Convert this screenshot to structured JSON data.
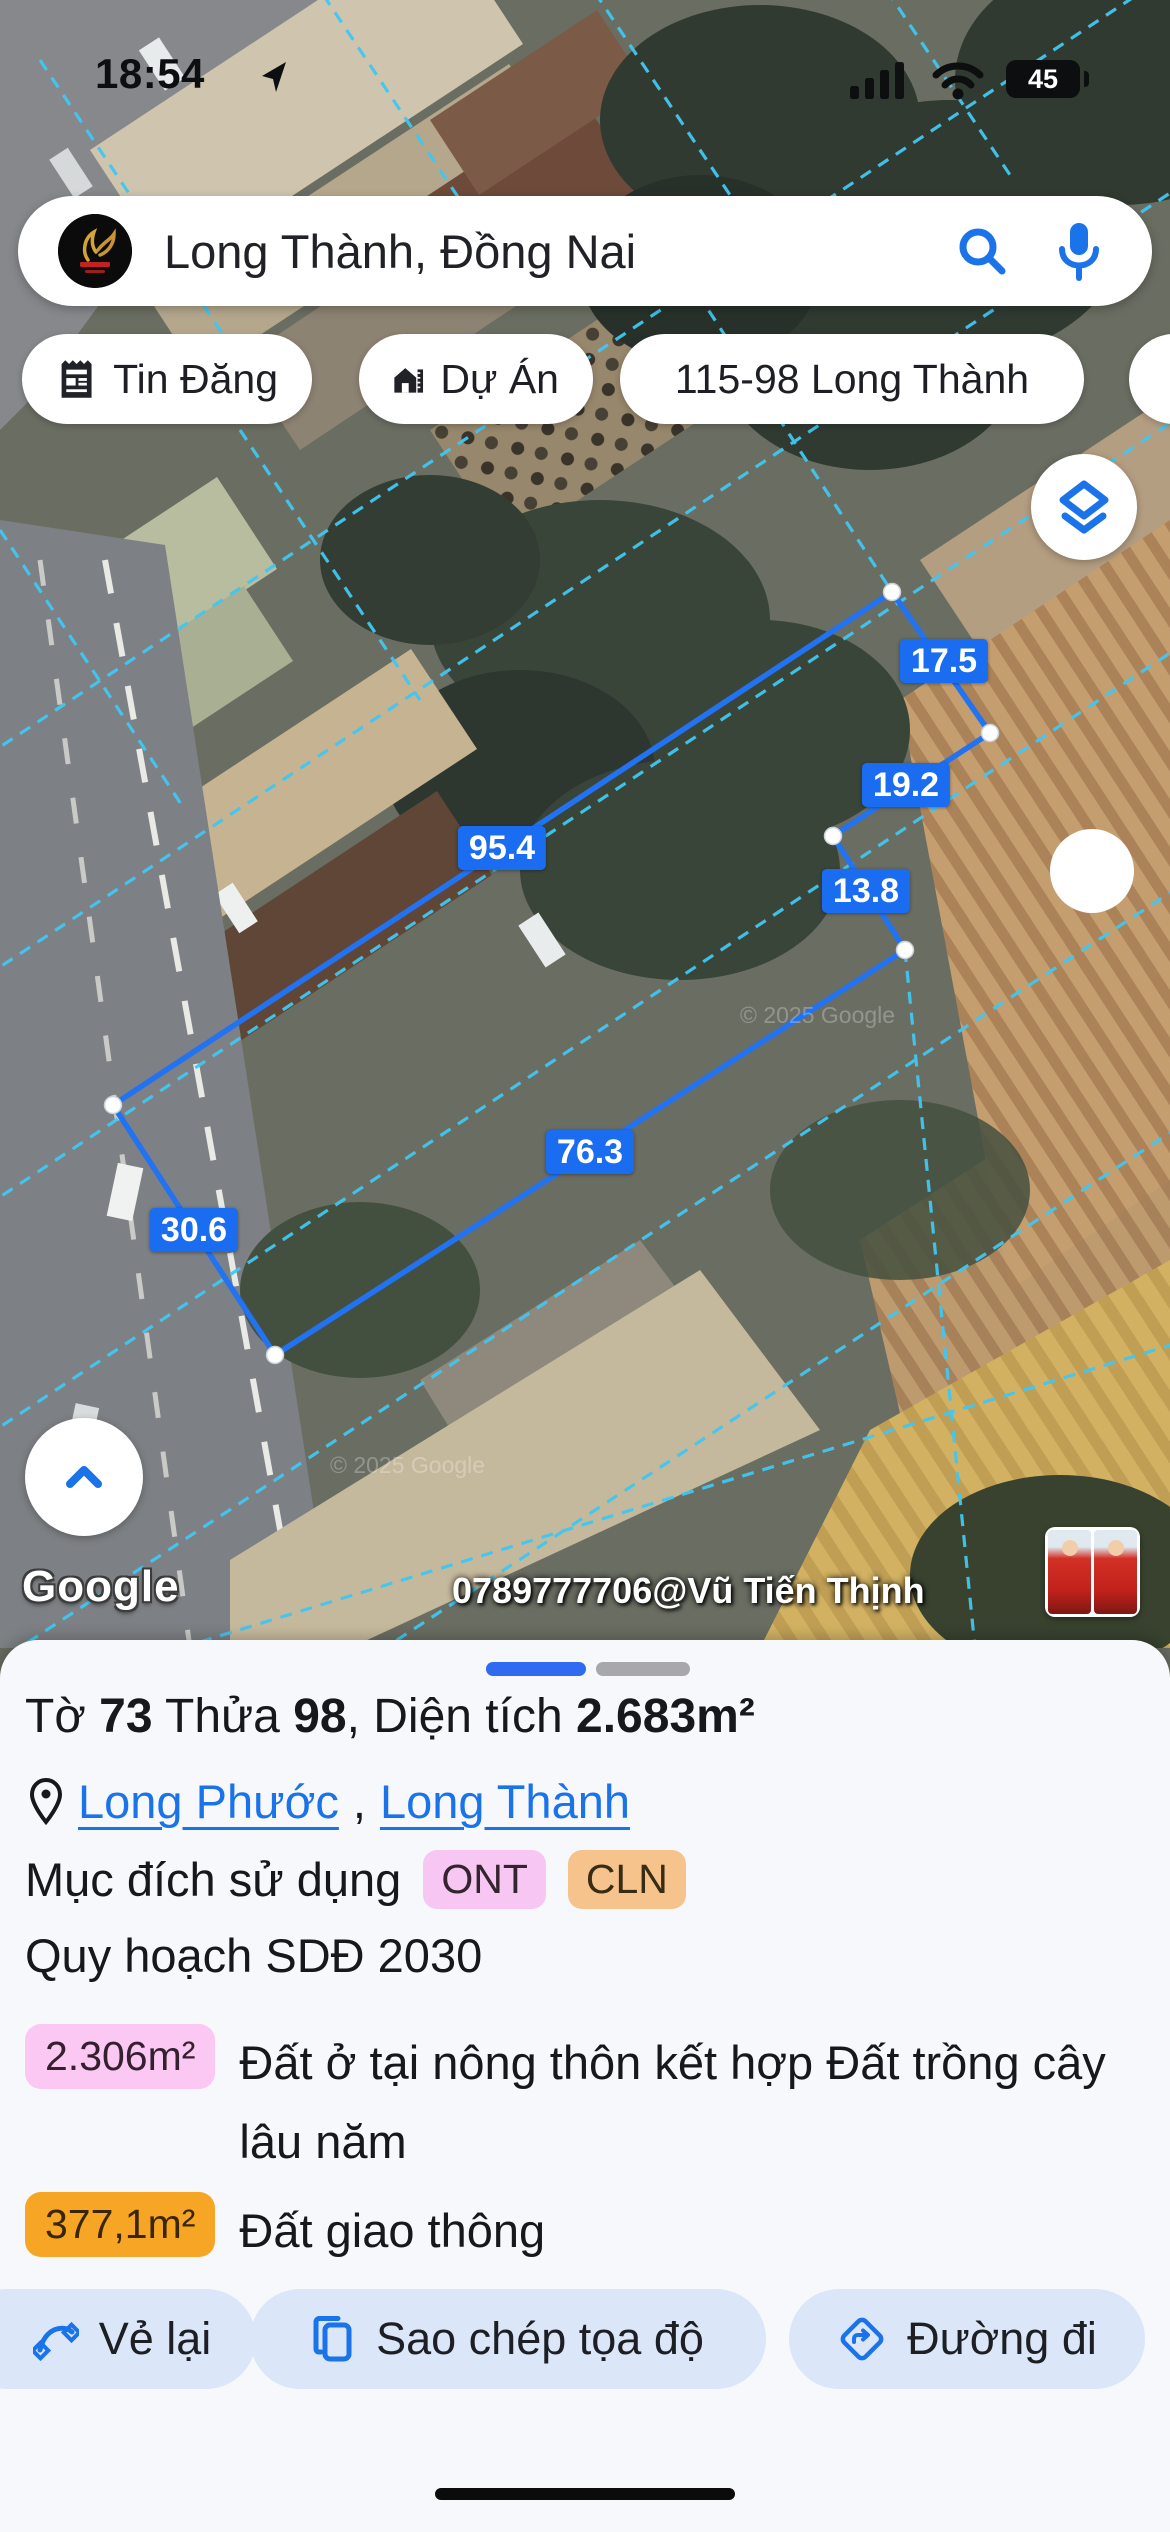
{
  "status_bar": {
    "time": "18:54",
    "battery": "45"
  },
  "search": {
    "query": "Long Thành, Đồng Nai"
  },
  "chips": [
    {
      "label": "Tin Đăng"
    },
    {
      "label": "Dự Án"
    },
    {
      "label": "115-98 Long Thành"
    },
    {
      "label": "3"
    }
  ],
  "map": {
    "measurements": [
      {
        "value": "17.5"
      },
      {
        "value": "19.2"
      },
      {
        "value": "13.8"
      },
      {
        "value": "95.4"
      },
      {
        "value": "76.3"
      },
      {
        "value": "30.6"
      }
    ],
    "google_logo": "Google",
    "watermark": "0789777706@Vũ Tiến Thịnh",
    "copyright": "© 2025 Google"
  },
  "sheet": {
    "title": {
      "p1": "Tờ ",
      "v1": "73",
      "p2": " Thửa ",
      "v2": "98",
      "p3": ", Diện tích ",
      "v3": "2.683m²"
    },
    "location": {
      "ward": "Long Phước",
      "comma": ",",
      "district": "Long Thành"
    },
    "purpose_label": "Mục đích sử dụng",
    "purpose_badges": [
      {
        "label": "ONT"
      },
      {
        "label": "CLN"
      }
    ],
    "plan_label": "Quy hoạch SDĐ 2030",
    "areas": [
      {
        "value": "2.306m²",
        "desc": "Đất ở tại nông thôn kết hợp Đất trồng cây lâu năm"
      },
      {
        "value": "377,1m²",
        "desc": "Đất giao thông"
      }
    ],
    "buttons": [
      {
        "label": "Vẻ lại"
      },
      {
        "label": "Sao chép tọa độ"
      },
      {
        "label": "Đường đi"
      }
    ]
  }
}
